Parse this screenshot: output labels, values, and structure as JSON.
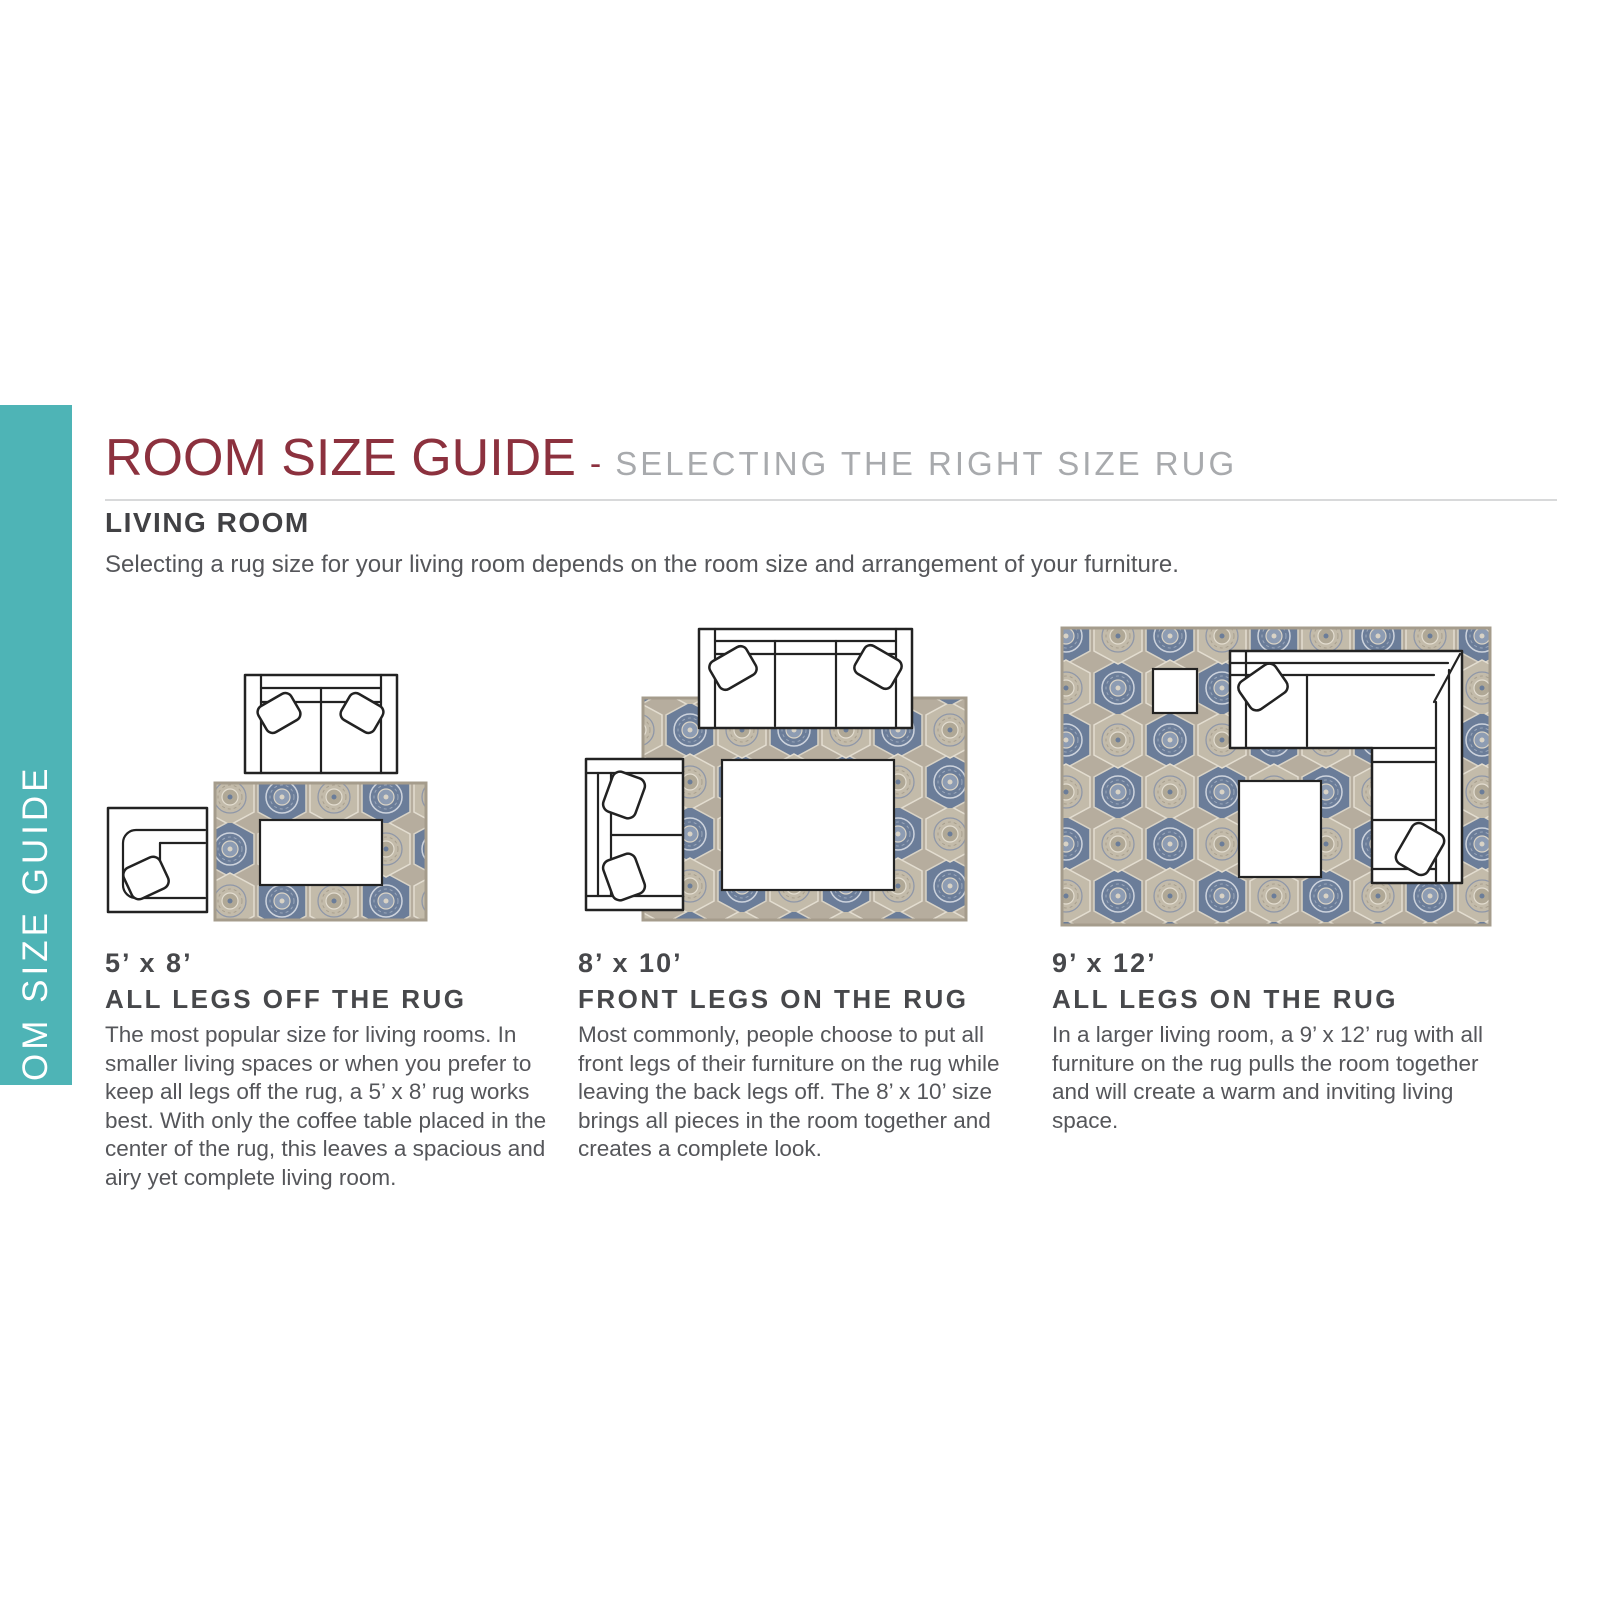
{
  "colors": {
    "accent_teal": "#4eb4b6",
    "title_maroon": "#8c313e",
    "heading_gray": "#414144",
    "body_gray": "#55565a",
    "subtitle_gray": "#a8aaad",
    "rug_base": "#b6ad9e",
    "rug_blue": "#6b7d99",
    "rug_cream": "#d9d3c6"
  },
  "sidebar": {
    "label": "ROOM SIZE GUIDE"
  },
  "header": {
    "title": "ROOM SIZE GUIDE",
    "separator": "-",
    "subtitle": "SELECTING THE RIGHT SIZE RUG"
  },
  "section": {
    "heading": "LIVING ROOM",
    "description": "Selecting a rug size for your living room depends on the room size and arrangement of your furniture."
  },
  "guides": [
    {
      "size": "5’ x 8’",
      "rule": "ALL LEGS OFF THE RUG",
      "text": "The most popular size for living rooms. In smaller living spaces or when you prefer to keep all legs off the rug, a 5’ x 8’ rug works best. With only the coffee table placed in the center of the rug, this leaves a spacious and airy yet complete living room."
    },
    {
      "size": "8’ x 10’",
      "rule": "FRONT LEGS ON THE RUG",
      "text": "Most commonly, people choose to put all front legs of their furniture on the rug while leaving the back legs off. The 8’ x 10’ size brings all pieces in the room together and creates a complete look."
    },
    {
      "size": "9’ x 12’",
      "rule": "ALL LEGS ON THE RUG",
      "text": "In a larger living room, a 9’ x 12’ rug with all furniture on the rug pulls the room together and will create a warm and inviting living space."
    }
  ]
}
